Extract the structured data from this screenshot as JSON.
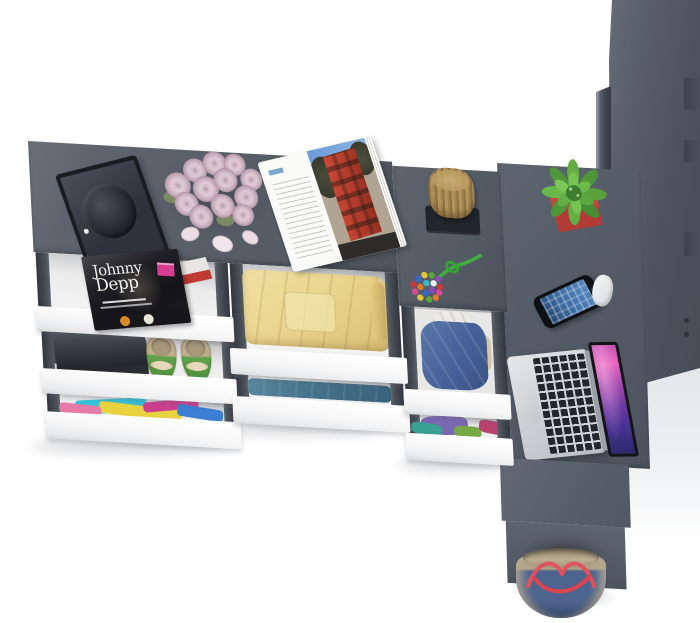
{
  "scene": {
    "description": "top-down render of a gray wardrobe and desk combination with open white drawers, clothes, laptop and accessories",
    "background_color": "#ffffff"
  },
  "palette": {
    "furniture_gray": "#575e68",
    "furniture_gray_dark": "#4a515b",
    "furniture_gray_light": "#6d7580",
    "drawer_front_white": "#fbfbfc",
    "drawer_rail_dark": "#3d434c",
    "blanket_yellow": "#e9d58d",
    "clothes_teal": "#4e7d94",
    "denim_blue": "#4a6694",
    "clothes_purple": "#7a68b3",
    "shoe_green": "#5f9e48",
    "cactus_green": "#5aa03c",
    "pot_red": "#b23c35",
    "stump_wood": "#b3945c",
    "rose_pink": "#dfc9d4",
    "bag_denim": "#4d648e",
    "bag_strap_red": "#e2525e",
    "laptop_silver": "#ced1d5",
    "laptop_screen_purple": "#8a42a8",
    "magazine_badge_pink": "#d93d92",
    "building_red": "#c64432"
  },
  "objects": {
    "magazine_cover": {
      "title_line1": "Johnny",
      "title_line2": "Depp"
    }
  }
}
